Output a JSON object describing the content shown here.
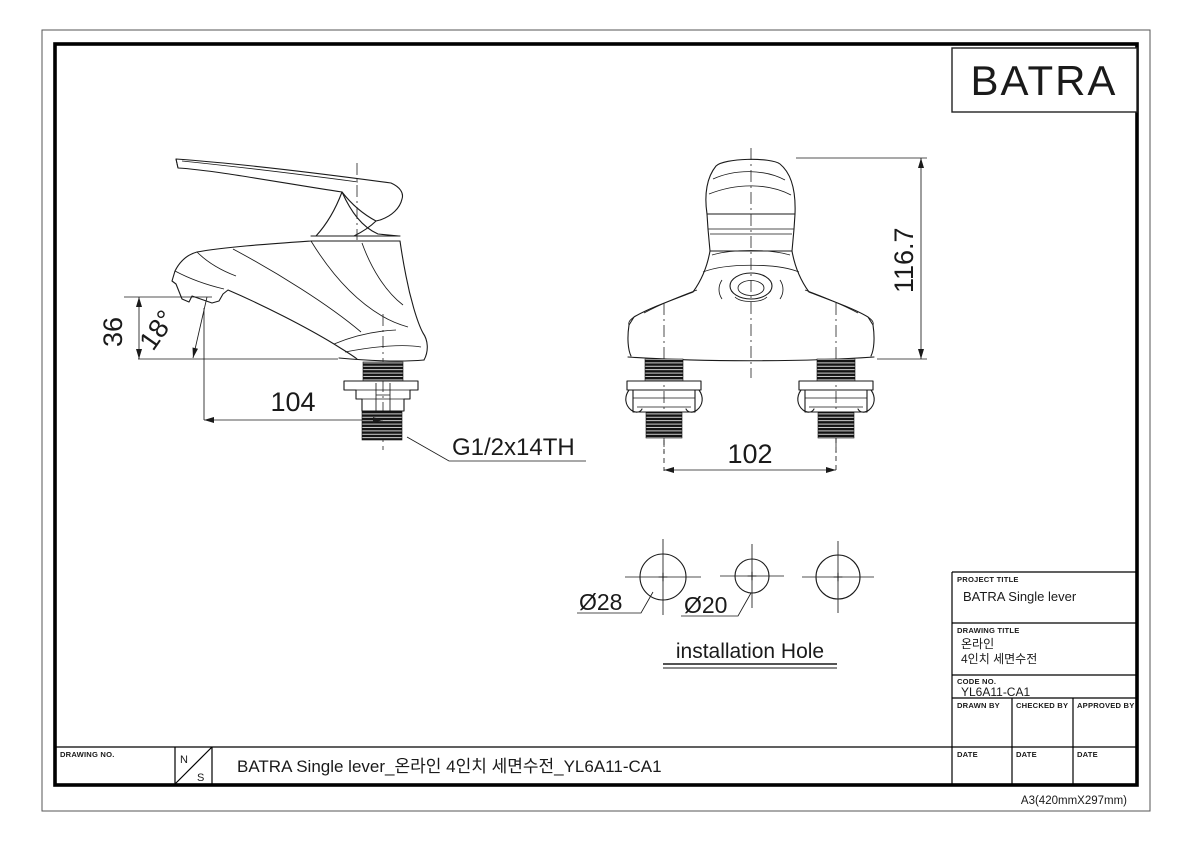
{
  "sheet": {
    "logo": "BATRA",
    "paper_note": "A3(420mmX297mm)"
  },
  "side_view": {
    "dim_height": "36",
    "dim_angle": "18°",
    "dim_length": "104",
    "thread_spec": "G1/2x14TH"
  },
  "front_view": {
    "dim_height": "116.7",
    "dim_spacing": "102"
  },
  "installation": {
    "hole_large": "Ø28",
    "hole_small": "Ø20",
    "caption": "installation Hole"
  },
  "title_block": {
    "project_title_label": "PROJECT TITLE",
    "project_title": "BATRA Single lever",
    "drawing_title_label": "DRAWING TITLE",
    "drawing_title_line1": "온라인",
    "drawing_title_line2": "4인치 세면수전",
    "code_no_label": "CODE NO.",
    "code_no": "YL6A11-CA1",
    "drawn_by_label": "DRAWN BY",
    "checked_by_label": "CHECKED BY",
    "approved_by_label": "APPROVED BY",
    "date_label": "DATE"
  },
  "bottom_strip": {
    "drawing_no_label": "DRAWING NO.",
    "scale_n": "N",
    "scale_s": "S",
    "title": "BATRA Single lever_온라인 4인치 세면수전_YL6A11-CA1"
  }
}
